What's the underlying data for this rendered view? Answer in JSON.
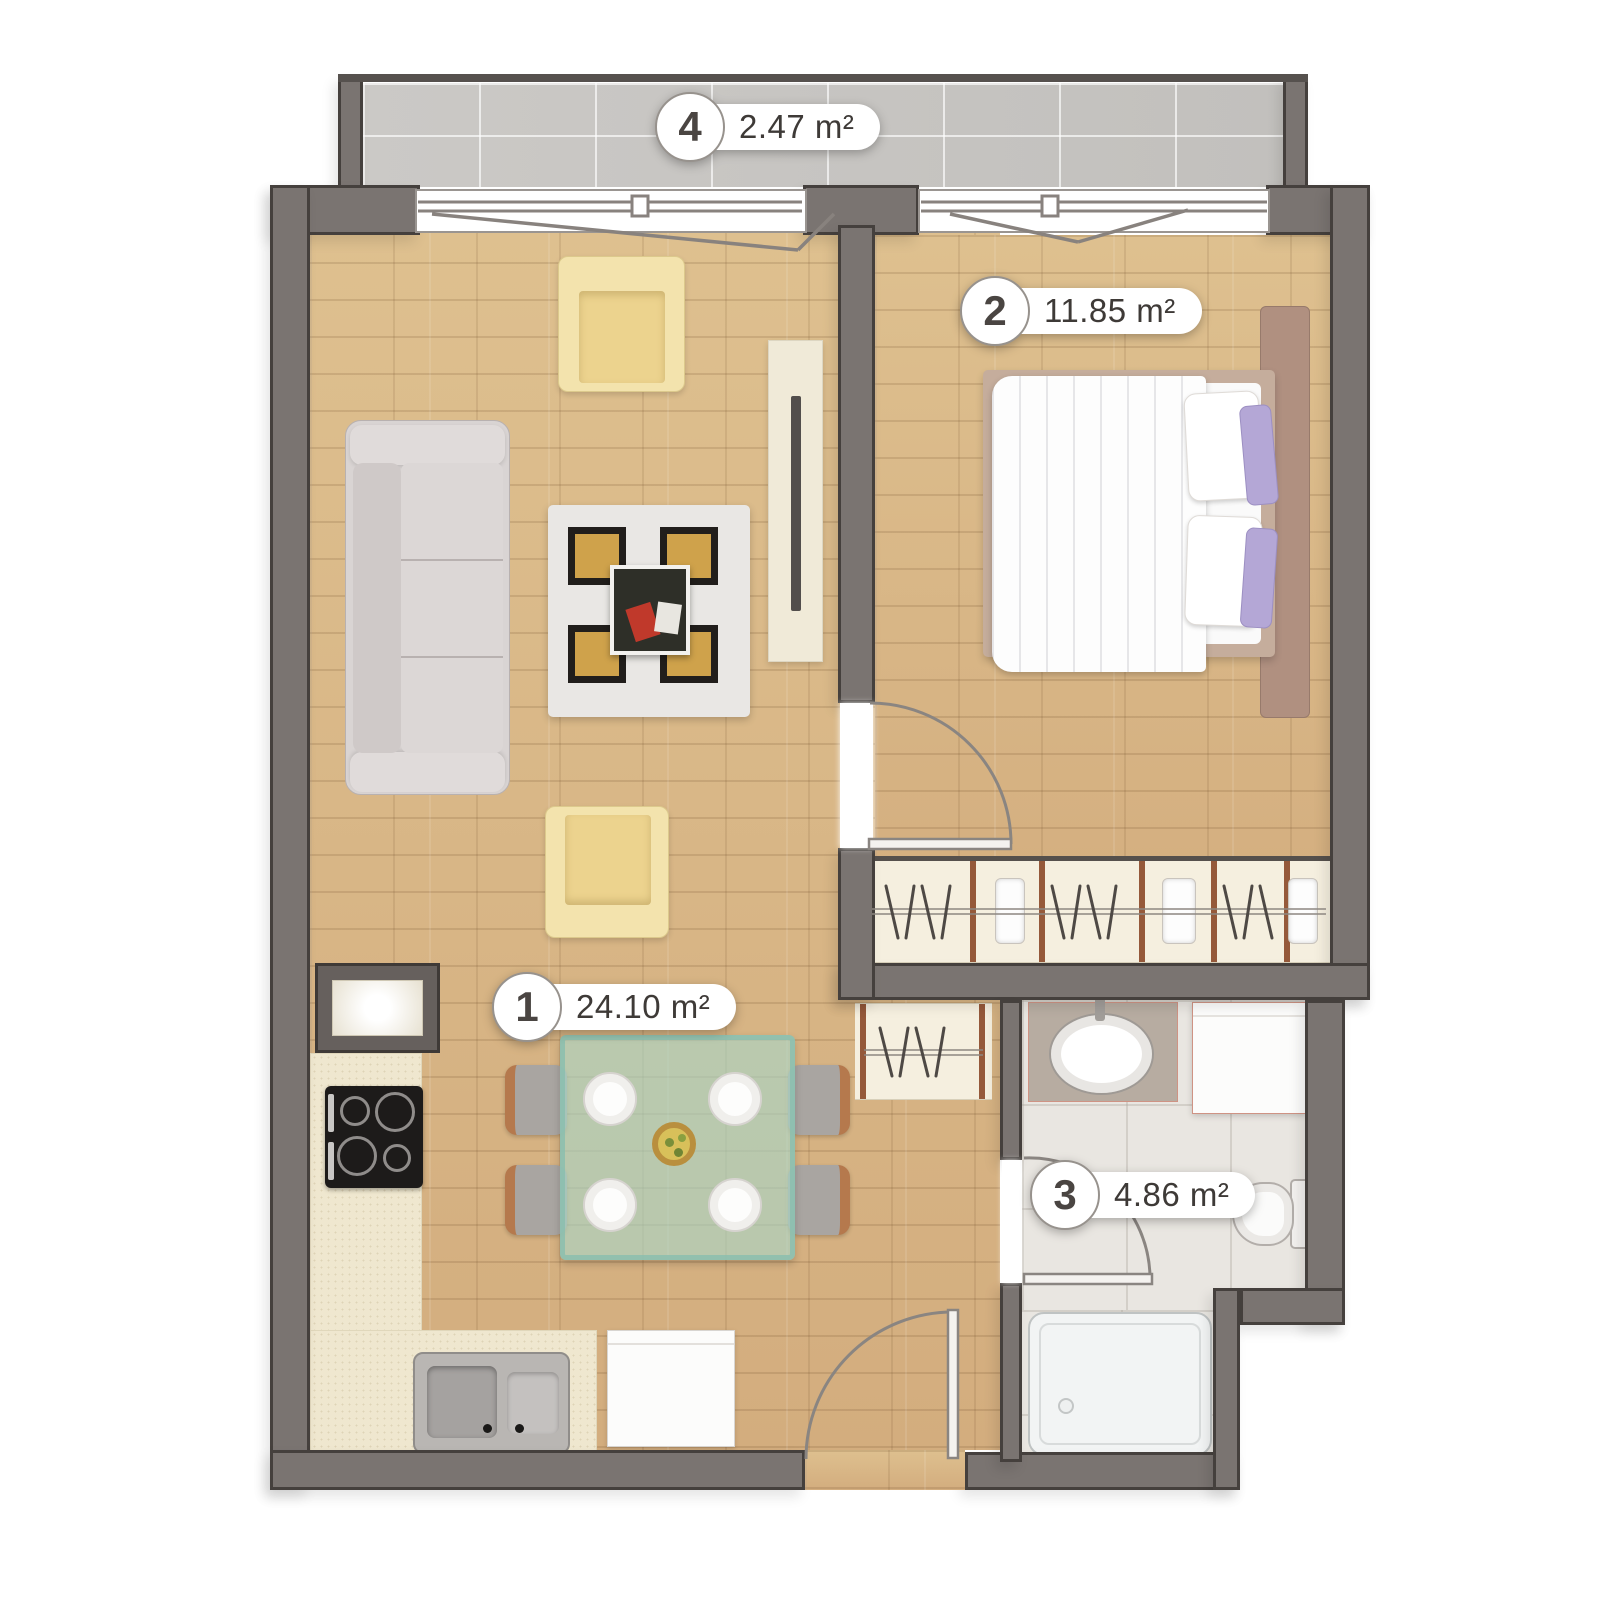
{
  "rooms": [
    {
      "number": "1",
      "area": "24.10 m²"
    },
    {
      "number": "2",
      "area": "11.85 m²"
    },
    {
      "number": "3",
      "area": "4.86 m²"
    },
    {
      "number": "4",
      "area": "2.47 m²"
    }
  ],
  "colors": {
    "wall": "#7a7471",
    "wall_outline": "#45403d",
    "wood_floor": "#d8b488",
    "balcony_tile": "#c9c7c4",
    "bathroom_tile": "#e9e6e1",
    "wardrobe_cream": "#f5efdf",
    "sofa_gray": "#d9d4d3",
    "armchair_yellow": "#f3e3ad",
    "rug_gold": "#cfa24b",
    "table_glass": "#a8d6c8",
    "headboard_brown": "#b09080",
    "pillow_purple": "#b4a7d6",
    "label_text": "#3e3a37"
  }
}
